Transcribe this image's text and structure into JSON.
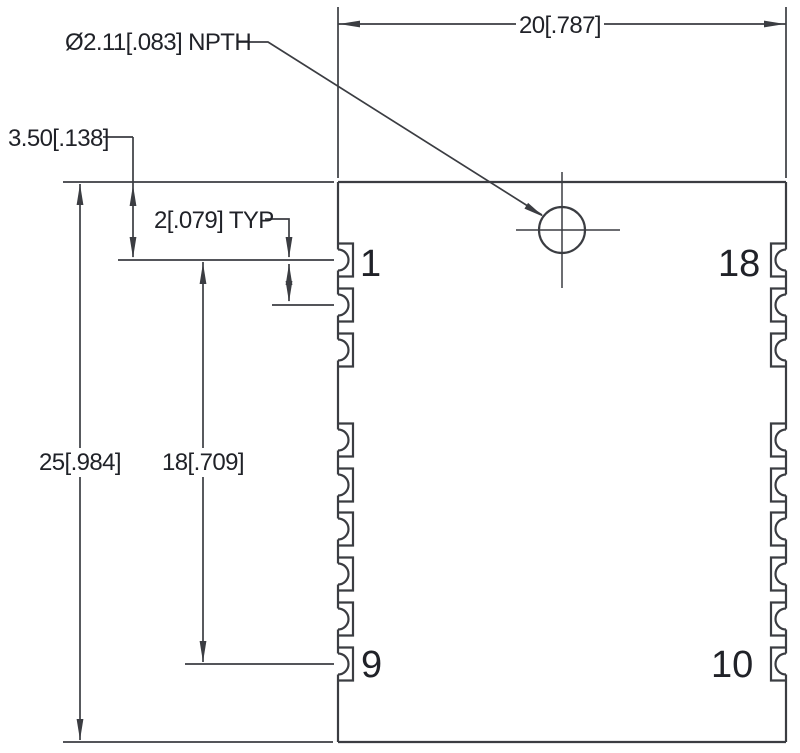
{
  "drawing": {
    "type": "mechanical-dimension-drawing",
    "labels": {
      "width_dim": "20[.787]",
      "height_dim": "25[.984]",
      "pad_span_dim": "18[.709]",
      "pitch_dim": "2[.079] TYP",
      "top_offset_dim": "3.50[.138]",
      "hole_callout": "Ø2.11[.083] NPTH"
    },
    "pins": {
      "top_left": "1",
      "bottom_left": "9",
      "top_right": "18",
      "bottom_right": "10"
    },
    "colors": {
      "line": "#3b3d42",
      "text": "#202228",
      "background": "#ffffff"
    }
  }
}
